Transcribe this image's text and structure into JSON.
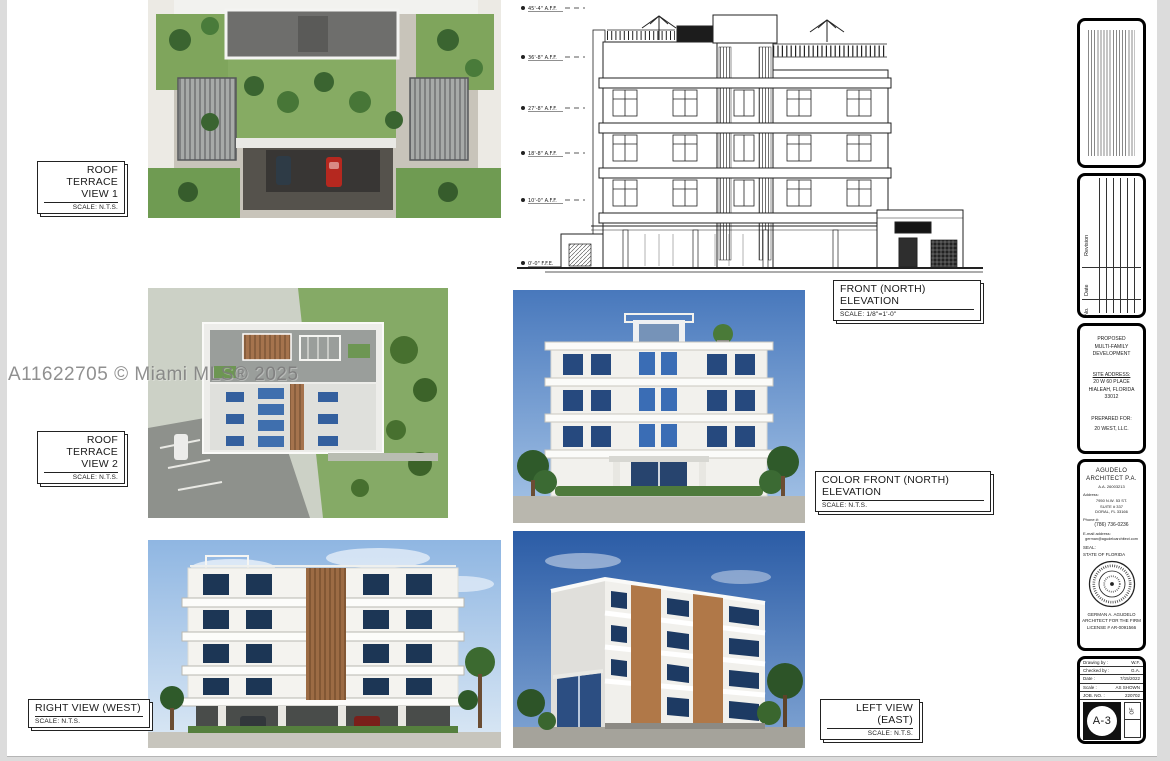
{
  "watermark": "A11622705 © Miami MLS® 2025",
  "labels": {
    "roof_terrace_1": {
      "title1": "ROOF TERRACE",
      "title2": "VIEW 1",
      "scale": "SCALE: N.T.S."
    },
    "roof_terrace_2": {
      "title1": "ROOF TERRACE",
      "title2": "VIEW 2",
      "scale": "SCALE: N.T.S."
    },
    "front_elevation": {
      "title": "FRONT (NORTH) ELEVATION",
      "scale": "SCALE: 1/8\"=1'-0\""
    },
    "color_front_elevation": {
      "title": "COLOR FRONT (NORTH) ELEVATION",
      "scale": "SCALE: N.T.S."
    },
    "right_view": {
      "title": "RIGHT VIEW (WEST)",
      "scale": "SCALE: N.T.S."
    },
    "left_view": {
      "title": "LEFT VIEW (EAST)",
      "scale": "SCALE: N.T.S."
    }
  },
  "front_elevation": {
    "markers": [
      "45'-4\" A.F.F.",
      "36'-8\" A.F.F.",
      "27'-8\" A.F.F.",
      "18'-8\" A.F.F.",
      "10'-0\" A.F.F.",
      "0'-0\" F.F.E."
    ]
  },
  "titleblock": {
    "revision_table": {
      "revision_label": "Revision",
      "date_label": "Date",
      "no_label": "No."
    },
    "project": {
      "line1": "PROPOSED",
      "line2": "MULTI-FAMILY",
      "line3": "DEVELOPMENT",
      "site_address_label": "SITE ADDRESS:",
      "address1": "20 W 60 PLACE",
      "address2": "HIALEAH, FLORIDA",
      "address3": "33012",
      "prepared_for_label": "PREPARED FOR:",
      "prepared_for": "20 WEST, LLC."
    },
    "architect": {
      "name1": "AGUDELO",
      "name2": "ARCHITECT P.A.",
      "license_no": "A.A. 26003213",
      "address_label": "Address:",
      "addr1": "7950 N.W. 53 ST.",
      "addr2": "SUITE # 337",
      "addr3": "DORAL, FL 33166",
      "phone_label": "Phone #:",
      "phone": "(786) 736-0236",
      "email_label": "E-mail address:",
      "email": "german@agudeloarchitect.com"
    },
    "seal": {
      "label1": "SEAL:",
      "label2": "STATE OF FLORIDA",
      "name": "GERMAN A. AGUDELO",
      "title": "ARCHITECT FOR THE FIRM",
      "license": "LICENSE # AR-0091566"
    },
    "info": {
      "rows": [
        {
          "label": "Drawing by :",
          "value": "W.F."
        },
        {
          "label": "Checked by :",
          "value": "G.A."
        },
        {
          "label": "Date :",
          "value": "7/15/2022"
        },
        {
          "label": "Scale :",
          "value": "AS SHOWN"
        },
        {
          "label": "JOB. NO. :",
          "value": "220702"
        }
      ],
      "sheet_number": "A-3",
      "of_label": "OF"
    }
  },
  "colors": {
    "page_gray": "#dcdcdc",
    "paper_white": "#ffffff",
    "line_black": "#1a1a1a",
    "sky_light": "#9dbfe6",
    "sky_deep": "#2b5ca6",
    "glass_blue": "#3f6fae",
    "window_navy": "#1c3655",
    "terracotta": "#b07848",
    "vegetation": "#3c6a30"
  }
}
